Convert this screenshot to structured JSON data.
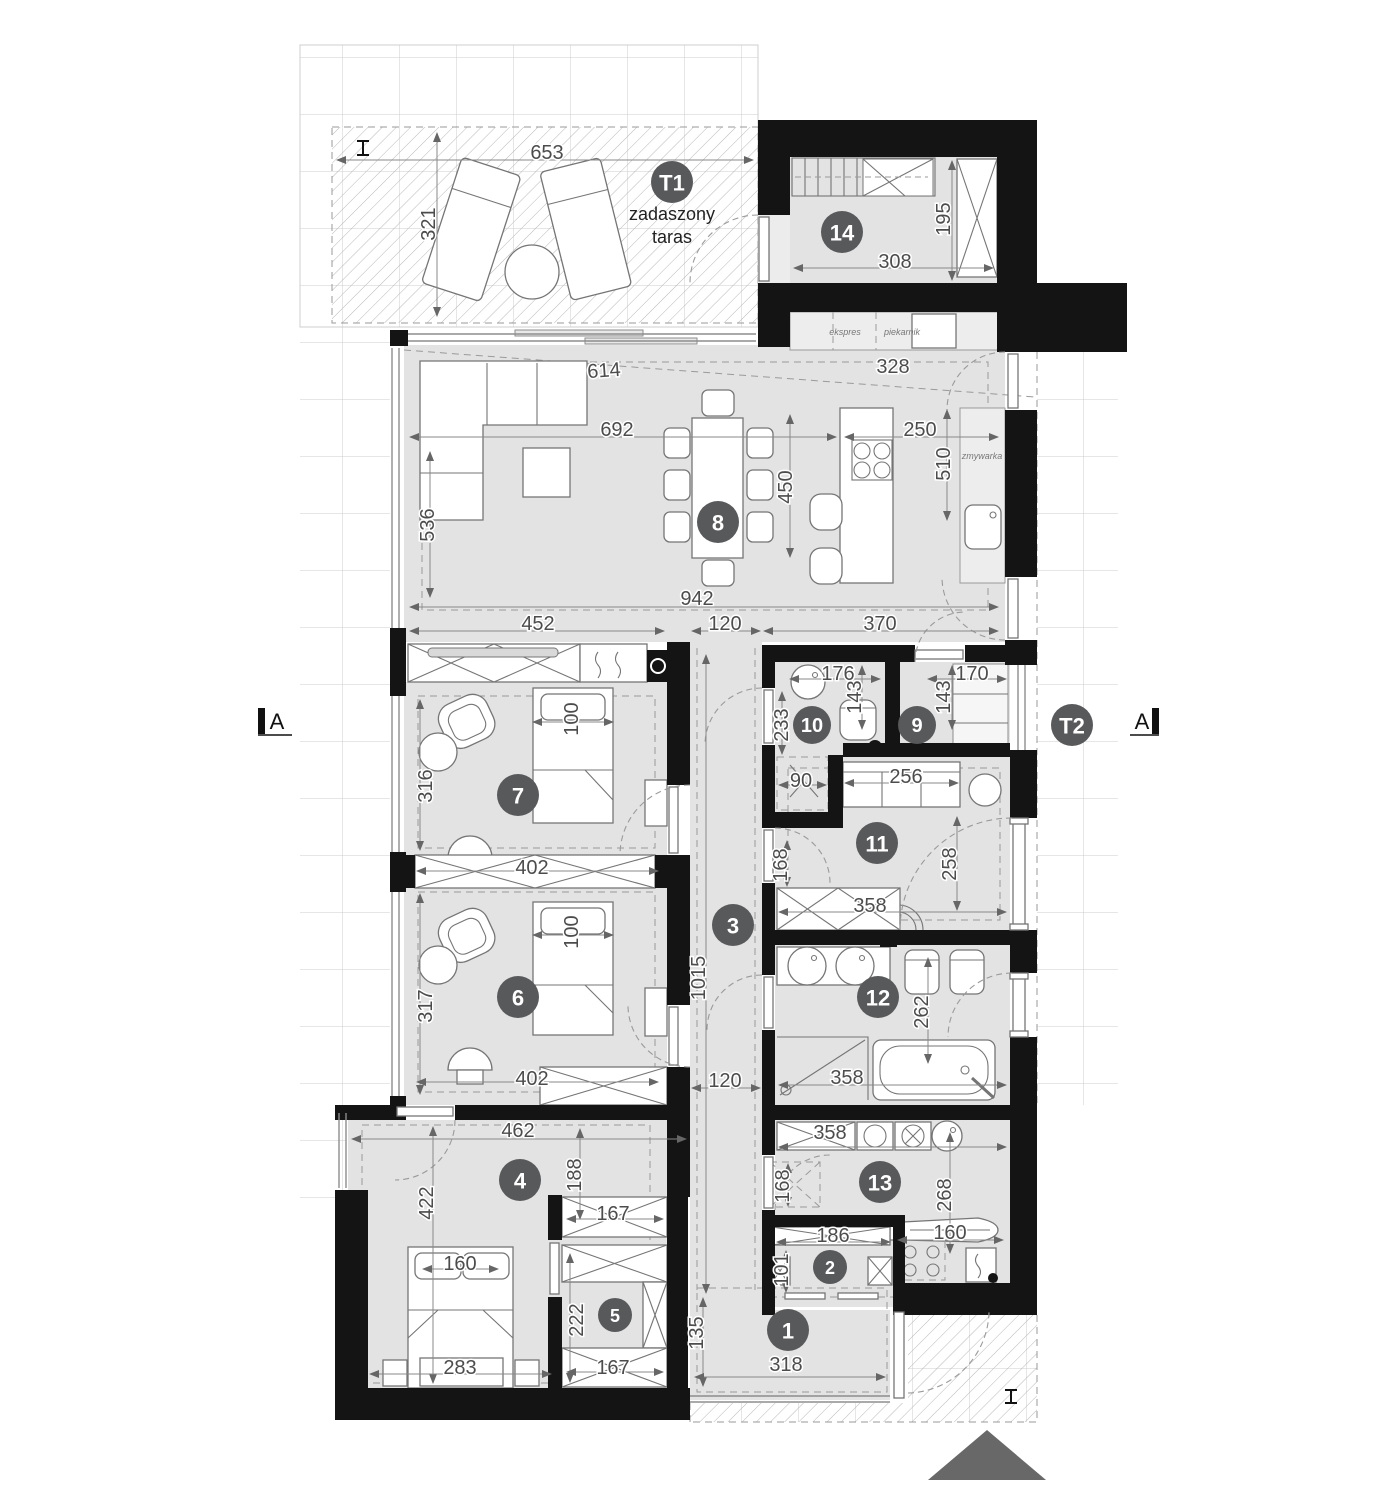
{
  "plan": {
    "type": "floor-plan",
    "units": "cm",
    "labels": {
      "terrace_line1": "zadaszony",
      "terrace_line2": "taras",
      "espresso": "ekspres",
      "oven": "piekarnik",
      "dishwasher": "zmywarka",
      "section_left": "A",
      "section_right": "A"
    },
    "colors": {
      "wall": "#141414",
      "room_fill": "#e3e3e3",
      "badge": "#58595b",
      "dim_text": "#4c4c4c",
      "grid_line": "#cccccc",
      "hatch_line": "#b8b8b8",
      "north_arrow": "#686868"
    },
    "rooms": [
      {
        "label": "1",
        "x": 788,
        "y": 1330,
        "r": 21
      },
      {
        "label": "2",
        "x": 830,
        "y": 1267,
        "r": 17
      },
      {
        "label": "3",
        "x": 733,
        "y": 925,
        "r": 21
      },
      {
        "label": "4",
        "x": 520,
        "y": 1180,
        "r": 21
      },
      {
        "label": "5",
        "x": 615,
        "y": 1315,
        "r": 17
      },
      {
        "label": "6",
        "x": 518,
        "y": 997,
        "r": 21
      },
      {
        "label": "7",
        "x": 518,
        "y": 795,
        "r": 21
      },
      {
        "label": "8",
        "x": 718,
        "y": 522,
        "r": 21
      },
      {
        "label": "9",
        "x": 917,
        "y": 725,
        "r": 19
      },
      {
        "label": "10",
        "x": 812,
        "y": 725,
        "r": 19
      },
      {
        "label": "11",
        "x": 877,
        "y": 843,
        "r": 21
      },
      {
        "label": "12",
        "x": 878,
        "y": 997,
        "r": 21
      },
      {
        "label": "13",
        "x": 880,
        "y": 1182,
        "r": 21
      },
      {
        "label": "14",
        "x": 842,
        "y": 232,
        "r": 21
      },
      {
        "label": "T1",
        "x": 672,
        "y": 182,
        "r": 21
      },
      {
        "label": "T2",
        "x": 1072,
        "y": 725,
        "r": 21
      }
    ],
    "dimensions": [
      {
        "t": "653",
        "x": 547,
        "y": 153
      },
      {
        "t": "321",
        "x": 429,
        "y": 224,
        "r": -90
      },
      {
        "t": "308",
        "x": 895,
        "y": 262
      },
      {
        "t": "195",
        "x": 944,
        "y": 219,
        "r": -90
      },
      {
        "t": "614",
        "x": 604,
        "y": 371,
        "r": -4
      },
      {
        "t": "328",
        "x": 893,
        "y": 367
      },
      {
        "t": "692",
        "x": 617,
        "y": 430
      },
      {
        "t": "250",
        "x": 920,
        "y": 430
      },
      {
        "t": "536",
        "x": 428,
        "y": 525,
        "r": -90
      },
      {
        "t": "450",
        "x": 786,
        "y": 487,
        "r": -90
      },
      {
        "t": "510",
        "x": 944,
        "y": 464,
        "r": -90
      },
      {
        "t": "942",
        "x": 697,
        "y": 599
      },
      {
        "t": "452",
        "x": 538,
        "y": 624
      },
      {
        "t": "120",
        "x": 725,
        "y": 624
      },
      {
        "t": "370",
        "x": 880,
        "y": 624
      },
      {
        "t": "100",
        "x": 572,
        "y": 719,
        "r": -90
      },
      {
        "t": "316",
        "x": 426,
        "y": 786,
        "r": -90
      },
      {
        "t": "402",
        "x": 532,
        "y": 868
      },
      {
        "t": "176",
        "x": 838,
        "y": 674
      },
      {
        "t": "143",
        "x": 855,
        "y": 697,
        "r": -90
      },
      {
        "t": "170",
        "x": 972,
        "y": 674
      },
      {
        "t": "143",
        "x": 944,
        "y": 697,
        "r": -90
      },
      {
        "t": "233",
        "x": 782,
        "y": 725,
        "r": -90
      },
      {
        "t": "90",
        "x": 801,
        "y": 781
      },
      {
        "t": "256",
        "x": 906,
        "y": 777
      },
      {
        "t": "258",
        "x": 950,
        "y": 864,
        "r": -90
      },
      {
        "t": "168",
        "x": 781,
        "y": 865,
        "r": -90
      },
      {
        "t": "358",
        "x": 870,
        "y": 906
      },
      {
        "t": "100",
        "x": 572,
        "y": 932,
        "r": -90
      },
      {
        "t": "317",
        "x": 426,
        "y": 1006,
        "r": -90
      },
      {
        "t": "402",
        "x": 532,
        "y": 1079
      },
      {
        "t": "1015",
        "x": 699,
        "y": 978,
        "r": -90
      },
      {
        "t": "120",
        "x": 725,
        "y": 1081
      },
      {
        "t": "262",
        "x": 922,
        "y": 1012,
        "r": -90
      },
      {
        "t": "358",
        "x": 847,
        "y": 1078
      },
      {
        "t": "358",
        "x": 830,
        "y": 1133
      },
      {
        "t": "268",
        "x": 945,
        "y": 1195,
        "r": -90
      },
      {
        "t": "168",
        "x": 783,
        "y": 1186,
        "r": -90
      },
      {
        "t": "462",
        "x": 518,
        "y": 1131
      },
      {
        "t": "422",
        "x": 427,
        "y": 1203,
        "r": -90
      },
      {
        "t": "188",
        "x": 575,
        "y": 1175,
        "r": -90
      },
      {
        "t": "167",
        "x": 613,
        "y": 1214
      },
      {
        "t": "160",
        "x": 460,
        "y": 1264
      },
      {
        "t": "222",
        "x": 577,
        "y": 1320,
        "r": -90
      },
      {
        "t": "167",
        "x": 613,
        "y": 1368
      },
      {
        "t": "283",
        "x": 460,
        "y": 1368
      },
      {
        "t": "135",
        "x": 697,
        "y": 1333,
        "r": -90
      },
      {
        "t": "318",
        "x": 786,
        "y": 1365
      },
      {
        "t": "186",
        "x": 833,
        "y": 1236
      },
      {
        "t": "160",
        "x": 950,
        "y": 1233
      },
      {
        "t": "101",
        "x": 782,
        "y": 1270,
        "r": -90
      }
    ]
  }
}
